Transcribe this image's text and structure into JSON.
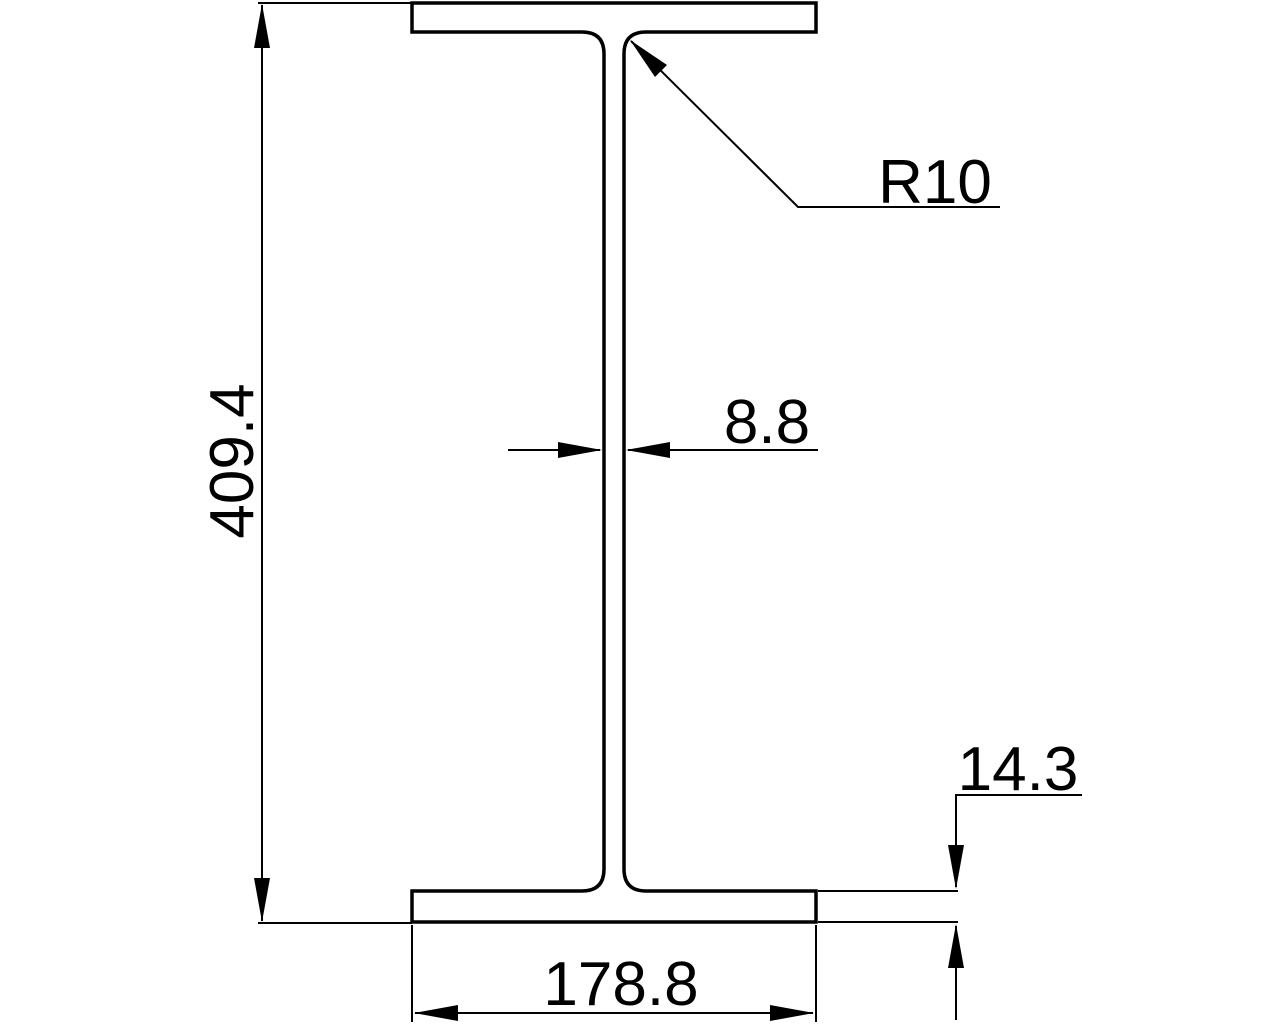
{
  "drawing": {
    "kind": "section-drawing",
    "shape": "i-beam-cross-section",
    "colors": {
      "line": "#000000",
      "background": "#ffffff"
    },
    "labels": {
      "overall_height": "409.4",
      "flange_width": "178.8",
      "web_thickness": "8.8",
      "flange_thickness": "14.3",
      "fillet_radius": "R10"
    }
  }
}
